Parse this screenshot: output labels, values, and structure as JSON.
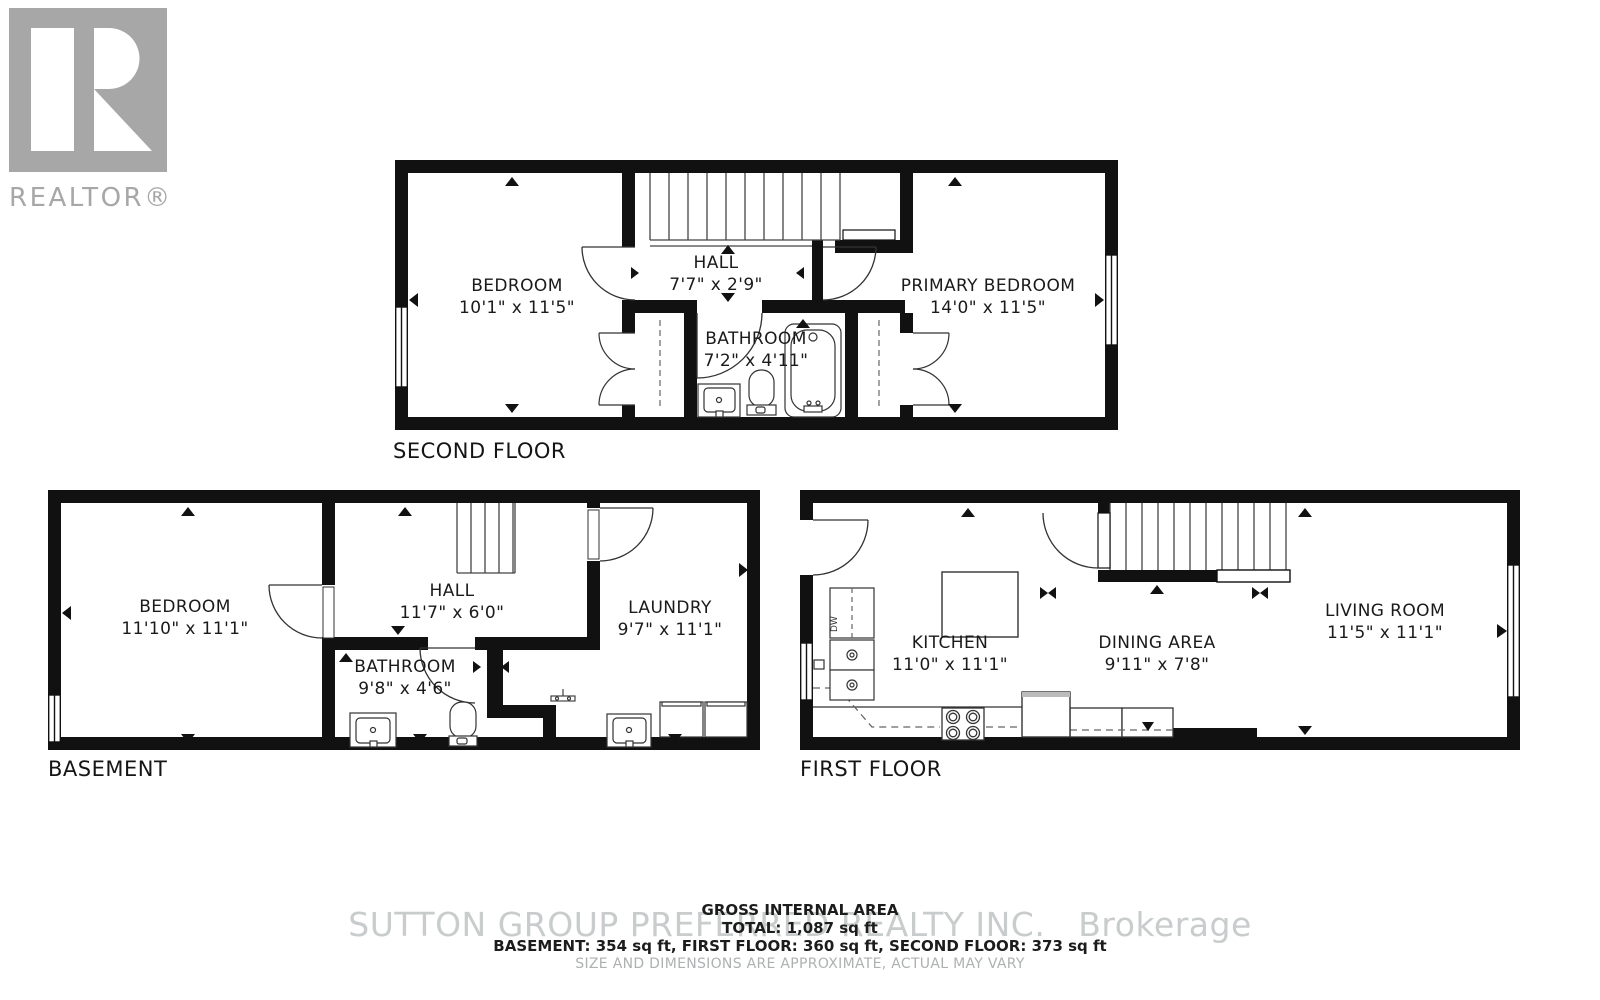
{
  "colors": {
    "wall": "#111111",
    "fixture_line": "#333333",
    "watermark": "#c8cccc",
    "logo_gray": "#a7a7a7",
    "label_text": "#1a1a1a",
    "muted_text": "#aeb1b1"
  },
  "logo": {
    "text": "REALTOR®"
  },
  "floors": {
    "second": {
      "title": "SECOND FLOOR",
      "rooms": {
        "bedroom": {
          "name": "BEDROOM",
          "dims": "10'1\" x 11'5\""
        },
        "hall": {
          "name": "HALL",
          "dims": "7'7\" x 2'9\""
        },
        "bathroom": {
          "name": "BATHROOM",
          "dims": "7'2\" x 4'11\""
        },
        "primary_bedroom": {
          "name": "PRIMARY BEDROOM",
          "dims": "14'0\" x 11'5\""
        }
      }
    },
    "basement": {
      "title": "BASEMENT",
      "rooms": {
        "bedroom": {
          "name": "BEDROOM",
          "dims": "11'10\" x 11'1\""
        },
        "hall": {
          "name": "HALL",
          "dims": "11'7\" x 6'0\""
        },
        "bathroom": {
          "name": "BATHROOM",
          "dims": "9'8\" x 4'6\""
        },
        "laundry": {
          "name": "LAUNDRY",
          "dims": "9'7\" x 11'1\""
        }
      }
    },
    "first": {
      "title": "FIRST FLOOR",
      "dw_label": "DW",
      "rooms": {
        "kitchen": {
          "name": "KITCHEN",
          "dims": "11'0\" x 11'1\""
        },
        "dining": {
          "name": "DINING AREA",
          "dims": "9'11\" x 7'8\""
        },
        "living": {
          "name": "LIVING ROOM",
          "dims": "11'5\" x 11'1\""
        }
      }
    }
  },
  "footer": {
    "heading": "GROSS INTERNAL AREA",
    "total": "TOTAL: 1,087 sq ft",
    "breakdown": "BASEMENT: 354 sq ft, FIRST FLOOR: 360 sq ft, SECOND FLOOR: 373 sq ft",
    "disclaimer": "SIZE AND DIMENSIONS ARE APPROXIMATE, ACTUAL MAY VARY"
  },
  "watermark": {
    "text": "SUTTON GROUP PREFERRED REALTY INC.   Brokerage"
  }
}
